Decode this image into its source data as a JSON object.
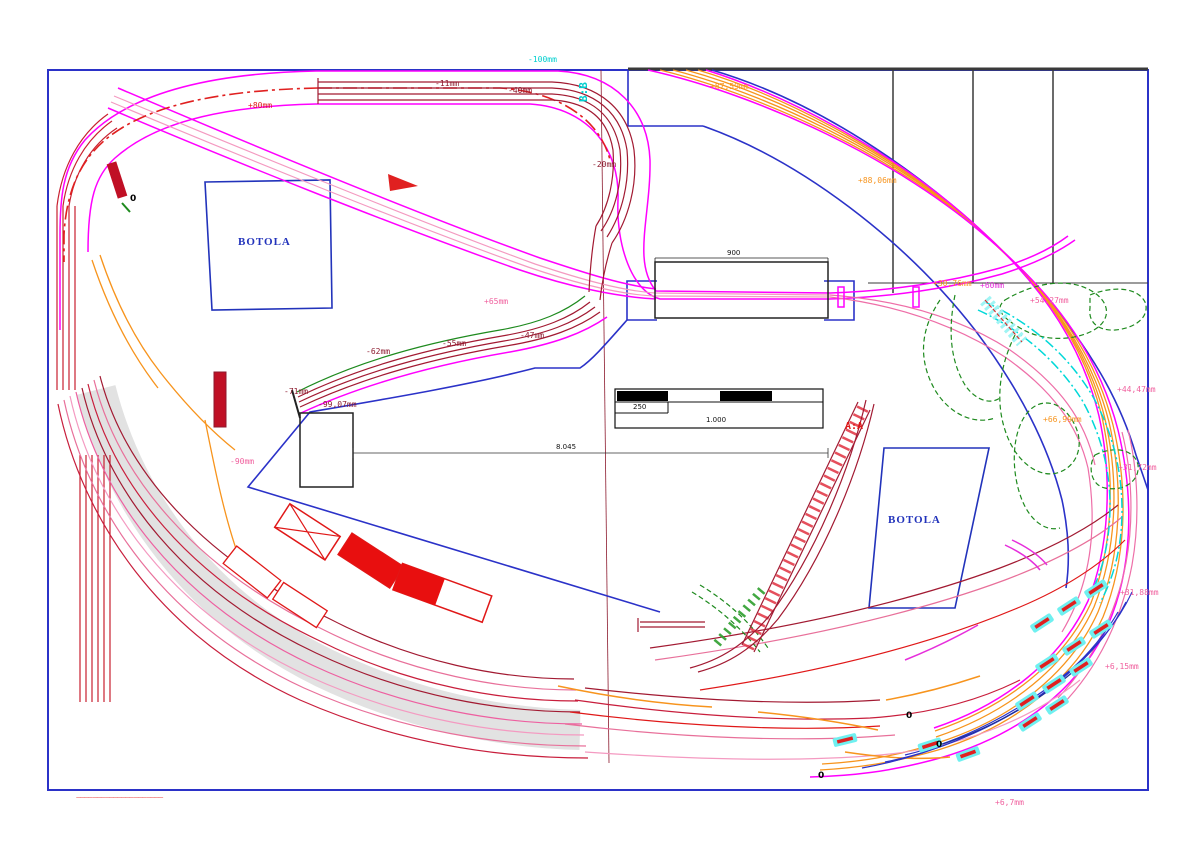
{
  "drawing": {
    "type": "model-railway-track-plan",
    "labels": {
      "plus80": "+80mm",
      "minus11": "-11mm",
      "minus40": "-40mm",
      "minus20": "-20mm",
      "minus100": "-100mm",
      "section_bb": "B:B",
      "plus87_59": "+87,59mm",
      "plus88_06": "+88,06mm",
      "plus65": "+65mm",
      "minus47": "-47mm",
      "minus55": "-55mm",
      "minus62": "-62mm",
      "minus71": "-71mm",
      "minus99_07": "-99,07mm",
      "minus90": "-90mm",
      "plus30_76": "+30,76mm",
      "plus60": "+60mm",
      "plus54_27": "+54,27mm",
      "plus66_99": "+66,99mm",
      "plus44_47": "+44,47mm",
      "plus31_72": "+31,72mm",
      "plus31_88": "+31,88mm",
      "plus6_15": "+6,15mm",
      "plus6_7": "+6,7mm",
      "section_aa": "A:A",
      "zero": "0"
    },
    "areas": {
      "botola": "BOTOLA"
    },
    "dimensions": {
      "bridge_width": "900",
      "layout_length": "8.045",
      "scale_segment": "250",
      "scale_total": "1.000"
    },
    "footer_note": "———— ——— ——————— ——— ————",
    "colors": {
      "magenta": "#FF00FF",
      "pink": "#F0609E",
      "crimson": "#A21A32",
      "red": "#E01818",
      "orange": "#F7941D",
      "green": "#1E8A1E",
      "blue": "#2B32C8",
      "cyan": "#00CFCF",
      "gray_band": "#E0E0E0"
    }
  }
}
